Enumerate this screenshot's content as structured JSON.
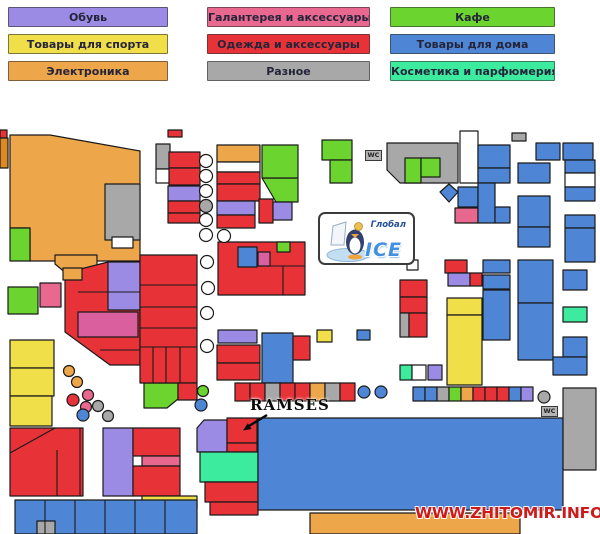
{
  "legend": {
    "items": [
      {
        "label": "Обувь",
        "color": "#9b8be4"
      },
      {
        "label": "Галантерея и аксессуары",
        "color": "#e9688f"
      },
      {
        "label": "Кафе",
        "color": "#6cd42e"
      },
      {
        "label": "Товары для спорта",
        "color": "#f0df48"
      },
      {
        "label": "Одежда и аксессуары",
        "color": "#e73338"
      },
      {
        "label": "Товары для дома",
        "color": "#4e86d5"
      },
      {
        "label": "Электроника",
        "color": "#eda64a"
      },
      {
        "label": "Разное",
        "color": "#a8a8a8"
      },
      {
        "label": "Косметика и парфюмерия",
        "color": "#3deb9e"
      }
    ]
  },
  "logo": {
    "title": "Глобал",
    "subtitle": "ICE"
  },
  "annotation": {
    "label": "RAMSES",
    "arrow": {
      "line": [
        267,
        415,
        249,
        426
      ],
      "head": "243,430.5 251.6,429 247.8,423.2"
    }
  },
  "wc": {
    "label": "WC"
  },
  "watermark": {
    "text": "WWW.ZHITOMIR.INFO"
  },
  "map": {
    "palette": {
      "red": "#e73338",
      "green": "#6cd42e",
      "blue": "#4e86d5",
      "purple": "#9b8be4",
      "orange": "#eda64a",
      "yellow": "#f0df48",
      "gray": "#a8a8a8",
      "pink": "#e9688f",
      "mint": "#3deb9e",
      "magenta": "#d95f9f",
      "dkorange": "#dd8a22",
      "white": "#ffffff"
    },
    "polys": [
      [
        "10,135 50,135 140,151 140,261 30,261 30,228 10,228",
        "orange"
      ],
      [
        "262,178 298,178 298,202 276,202",
        "green"
      ],
      [
        "387,143 458,143 458,183 400,183 387,170",
        "gray"
      ],
      [
        "449,184 458,192 449,202 440,192",
        "blue"
      ],
      [
        "55,255 97,255 97,268 72,278 55,264",
        "orange"
      ],
      [
        "65,273 108,262 140,262 140,365 110,365 65,332",
        "red"
      ],
      [
        "144,383 178,383 178,399 167,408 144,408",
        "green"
      ],
      [
        "204,420 227,420 227,452 197,452 197,428",
        "purple"
      ]
    ],
    "blocks": [
      [
        105,
        184,
        35,
        56,
        "gray"
      ],
      [
        112,
        237,
        21,
        11,
        "white"
      ],
      [
        0,
        130,
        7,
        8,
        "red"
      ],
      [
        0,
        138,
        8,
        30,
        "dkorange"
      ],
      [
        10,
        228,
        20,
        33,
        "green"
      ],
      [
        168,
        130,
        14,
        7,
        "red"
      ],
      [
        156,
        144,
        14,
        25,
        "gray"
      ],
      [
        156,
        169,
        14,
        14,
        "white"
      ],
      [
        169,
        152,
        31,
        16,
        "red"
      ],
      [
        169,
        168,
        31,
        17,
        "red"
      ],
      [
        168,
        186,
        32,
        15,
        "purple"
      ],
      [
        168,
        201,
        32,
        12,
        "red"
      ],
      [
        168,
        213,
        32,
        10,
        "red"
      ],
      [
        217,
        145,
        43,
        17,
        "orange"
      ],
      [
        217,
        162,
        43,
        10,
        "white"
      ],
      [
        217,
        172,
        43,
        12,
        "red"
      ],
      [
        217,
        184,
        43,
        17,
        "red"
      ],
      [
        217,
        201,
        38,
        14,
        "purple"
      ],
      [
        217,
        215,
        38,
        13,
        "red"
      ],
      [
        259,
        199,
        14,
        24,
        "red"
      ],
      [
        273,
        202,
        19,
        18,
        "purple"
      ],
      [
        262,
        145,
        36,
        33,
        "green"
      ],
      [
        322,
        140,
        30,
        20,
        "green"
      ],
      [
        330,
        160,
        22,
        23,
        "green"
      ],
      [
        405,
        158,
        16,
        25,
        "green"
      ],
      [
        421,
        158,
        19,
        19,
        "green"
      ],
      [
        460,
        131,
        18,
        52,
        "white"
      ],
      [
        512,
        133,
        14,
        8,
        "gray"
      ],
      [
        478,
        145,
        32,
        23,
        "blue"
      ],
      [
        478,
        168,
        32,
        15,
        "blue"
      ],
      [
        536,
        143,
        24,
        17,
        "blue"
      ],
      [
        563,
        143,
        30,
        17,
        "blue"
      ],
      [
        565,
        160,
        30,
        13,
        "blue"
      ],
      [
        565,
        173,
        30,
        14,
        "white"
      ],
      [
        565,
        187,
        30,
        14,
        "blue"
      ],
      [
        565,
        215,
        30,
        13,
        "blue"
      ],
      [
        565,
        228,
        30,
        34,
        "blue"
      ],
      [
        518,
        163,
        32,
        20,
        "blue"
      ],
      [
        518,
        196,
        32,
        31,
        "blue"
      ],
      [
        518,
        227,
        32,
        20,
        "blue"
      ],
      [
        458,
        187,
        20,
        20,
        "blue"
      ],
      [
        455,
        208,
        23,
        15,
        "pink"
      ],
      [
        478,
        183,
        17,
        40,
        "blue"
      ],
      [
        495,
        207,
        15,
        16,
        "blue"
      ],
      [
        483,
        260,
        27,
        13,
        "blue"
      ],
      [
        483,
        275,
        27,
        14,
        "blue"
      ],
      [
        483,
        290,
        27,
        50,
        "blue"
      ],
      [
        518,
        260,
        35,
        43,
        "blue"
      ],
      [
        518,
        303,
        35,
        57,
        "blue"
      ],
      [
        563,
        270,
        24,
        20,
        "blue"
      ],
      [
        563,
        307,
        24,
        15,
        "mint"
      ],
      [
        563,
        337,
        24,
        20,
        "blue"
      ],
      [
        553,
        357,
        34,
        18,
        "blue"
      ],
      [
        407,
        260,
        11,
        10,
        "white"
      ],
      [
        445,
        260,
        22,
        13,
        "red"
      ],
      [
        448,
        273,
        22,
        13,
        "purple"
      ],
      [
        470,
        273,
        12,
        13,
        "red"
      ],
      [
        400,
        280,
        27,
        17,
        "red"
      ],
      [
        400,
        297,
        27,
        16,
        "red"
      ],
      [
        400,
        313,
        9,
        24,
        "gray"
      ],
      [
        409,
        313,
        18,
        24,
        "red"
      ],
      [
        447,
        298,
        35,
        17,
        "yellow"
      ],
      [
        447,
        315,
        35,
        70,
        "yellow"
      ],
      [
        400,
        365,
        12,
        15,
        "mint"
      ],
      [
        412,
        365,
        14,
        15,
        "white"
      ],
      [
        428,
        365,
        14,
        15,
        "purple"
      ],
      [
        218,
        242,
        87,
        53,
        "red"
      ],
      [
        277,
        242,
        13,
        10,
        "green"
      ],
      [
        238,
        247,
        19,
        20,
        "blue"
      ],
      [
        258,
        252,
        12,
        14,
        "magenta"
      ],
      [
        108,
        262,
        32,
        48,
        "purple"
      ],
      [
        78,
        312,
        60,
        25,
        "magenta"
      ],
      [
        140,
        255,
        57,
        128,
        "red"
      ],
      [
        178,
        383,
        19,
        17,
        "red"
      ],
      [
        63,
        268,
        19,
        12,
        "orange"
      ],
      [
        40,
        283,
        21,
        24,
        "pink"
      ],
      [
        8,
        287,
        30,
        27,
        "green"
      ],
      [
        10,
        340,
        44,
        28,
        "yellow"
      ],
      [
        10,
        368,
        44,
        28,
        "yellow"
      ],
      [
        10,
        396,
        42,
        30,
        "yellow"
      ],
      [
        10,
        428,
        73,
        68,
        "red"
      ],
      [
        103,
        428,
        30,
        68,
        "purple"
      ],
      [
        133,
        428,
        47,
        28,
        "red"
      ],
      [
        142,
        456,
        38,
        10,
        "pink"
      ],
      [
        133,
        466,
        47,
        30,
        "red"
      ],
      [
        142,
        496,
        55,
        13,
        "yellow"
      ],
      [
        15,
        500,
        182,
        34,
        "blue"
      ],
      [
        37,
        521,
        18,
        13,
        "gray"
      ],
      [
        218,
        330,
        39,
        13,
        "purple"
      ],
      [
        217,
        345,
        43,
        18,
        "red"
      ],
      [
        217,
        363,
        43,
        17,
        "red"
      ],
      [
        262,
        333,
        31,
        50,
        "blue"
      ],
      [
        293,
        336,
        17,
        24,
        "red"
      ],
      [
        317,
        330,
        15,
        12,
        "yellow"
      ],
      [
        357,
        330,
        13,
        10,
        "blue"
      ],
      [
        235,
        383,
        15,
        18,
        "red"
      ],
      [
        250,
        383,
        15,
        18,
        "red"
      ],
      [
        265,
        383,
        15,
        18,
        "gray"
      ],
      [
        280,
        383,
        15,
        18,
        "red"
      ],
      [
        295,
        383,
        15,
        18,
        "red"
      ],
      [
        310,
        383,
        15,
        18,
        "orange"
      ],
      [
        325,
        383,
        15,
        18,
        "gray"
      ],
      [
        340,
        383,
        15,
        18,
        "red"
      ],
      [
        413,
        387,
        12,
        14,
        "blue"
      ],
      [
        425,
        387,
        12,
        14,
        "blue"
      ],
      [
        437,
        387,
        12,
        14,
        "gray"
      ],
      [
        449,
        387,
        12,
        14,
        "green"
      ],
      [
        461,
        387,
        12,
        14,
        "orange"
      ],
      [
        473,
        387,
        12,
        14,
        "red"
      ],
      [
        485,
        387,
        12,
        14,
        "red"
      ],
      [
        497,
        387,
        12,
        14,
        "red"
      ],
      [
        509,
        387,
        12,
        14,
        "blue"
      ],
      [
        521,
        387,
        12,
        14,
        "purple"
      ],
      [
        227,
        418,
        30,
        25,
        "red"
      ],
      [
        227,
        443,
        30,
        9,
        "red"
      ],
      [
        200,
        452,
        58,
        30,
        "mint"
      ],
      [
        205,
        482,
        53,
        20,
        "red"
      ],
      [
        210,
        502,
        48,
        13,
        "red"
      ],
      [
        258,
        418,
        305,
        92,
        "blue"
      ],
      [
        563,
        388,
        33,
        82,
        "gray"
      ],
      [
        310,
        513,
        210,
        21,
        "orange"
      ]
    ],
    "circles": [
      [
        206,
        161,
        6.5,
        "white"
      ],
      [
        206,
        176,
        6.5,
        "white"
      ],
      [
        206,
        191,
        6.5,
        "white"
      ],
      [
        206,
        206,
        6.5,
        "gray"
      ],
      [
        206,
        220,
        6.5,
        "white"
      ],
      [
        206,
        235,
        6.5,
        "white"
      ],
      [
        224,
        236,
        6.5,
        "white"
      ],
      [
        207,
        262,
        6.5,
        "white"
      ],
      [
        208,
        288,
        6.5,
        "white"
      ],
      [
        207,
        313,
        6.5,
        "white"
      ],
      [
        207,
        346,
        6.5,
        "white"
      ],
      [
        69,
        371,
        5.5,
        "orange"
      ],
      [
        77,
        382,
        5.5,
        "orange"
      ],
      [
        88,
        395,
        5.5,
        "pink"
      ],
      [
        73,
        400,
        6,
        "red"
      ],
      [
        86,
        407,
        5.5,
        "pink"
      ],
      [
        83,
        415,
        6,
        "blue"
      ],
      [
        98,
        406,
        5.5,
        "gray"
      ],
      [
        108,
        416,
        5.5,
        "gray"
      ],
      [
        203,
        391,
        5.5,
        "green"
      ],
      [
        201,
        405,
        6,
        "blue"
      ],
      [
        364,
        392,
        6,
        "blue"
      ],
      [
        381,
        392,
        6,
        "blue"
      ],
      [
        544,
        397,
        6,
        "gray"
      ]
    ],
    "lines": [
      [
        140,
        285,
        197,
        285
      ],
      [
        140,
        307,
        197,
        307
      ],
      [
        140,
        328,
        197,
        328
      ],
      [
        140,
        347,
        197,
        347
      ],
      [
        153,
        347,
        153,
        383
      ],
      [
        166,
        347,
        166,
        383
      ],
      [
        180,
        347,
        180,
        383
      ],
      [
        78,
        292,
        140,
        292
      ],
      [
        100,
        350,
        140,
        350
      ],
      [
        10,
        453,
        55,
        428
      ],
      [
        80,
        428,
        80,
        496
      ],
      [
        57,
        450,
        57,
        496
      ],
      [
        45,
        500,
        45,
        534
      ],
      [
        75,
        500,
        75,
        534
      ],
      [
        105,
        500,
        105,
        534
      ],
      [
        135,
        500,
        135,
        534
      ],
      [
        165,
        500,
        165,
        534
      ],
      [
        258,
        266,
        305,
        266
      ],
      [
        283,
        266,
        283,
        295
      ]
    ]
  }
}
